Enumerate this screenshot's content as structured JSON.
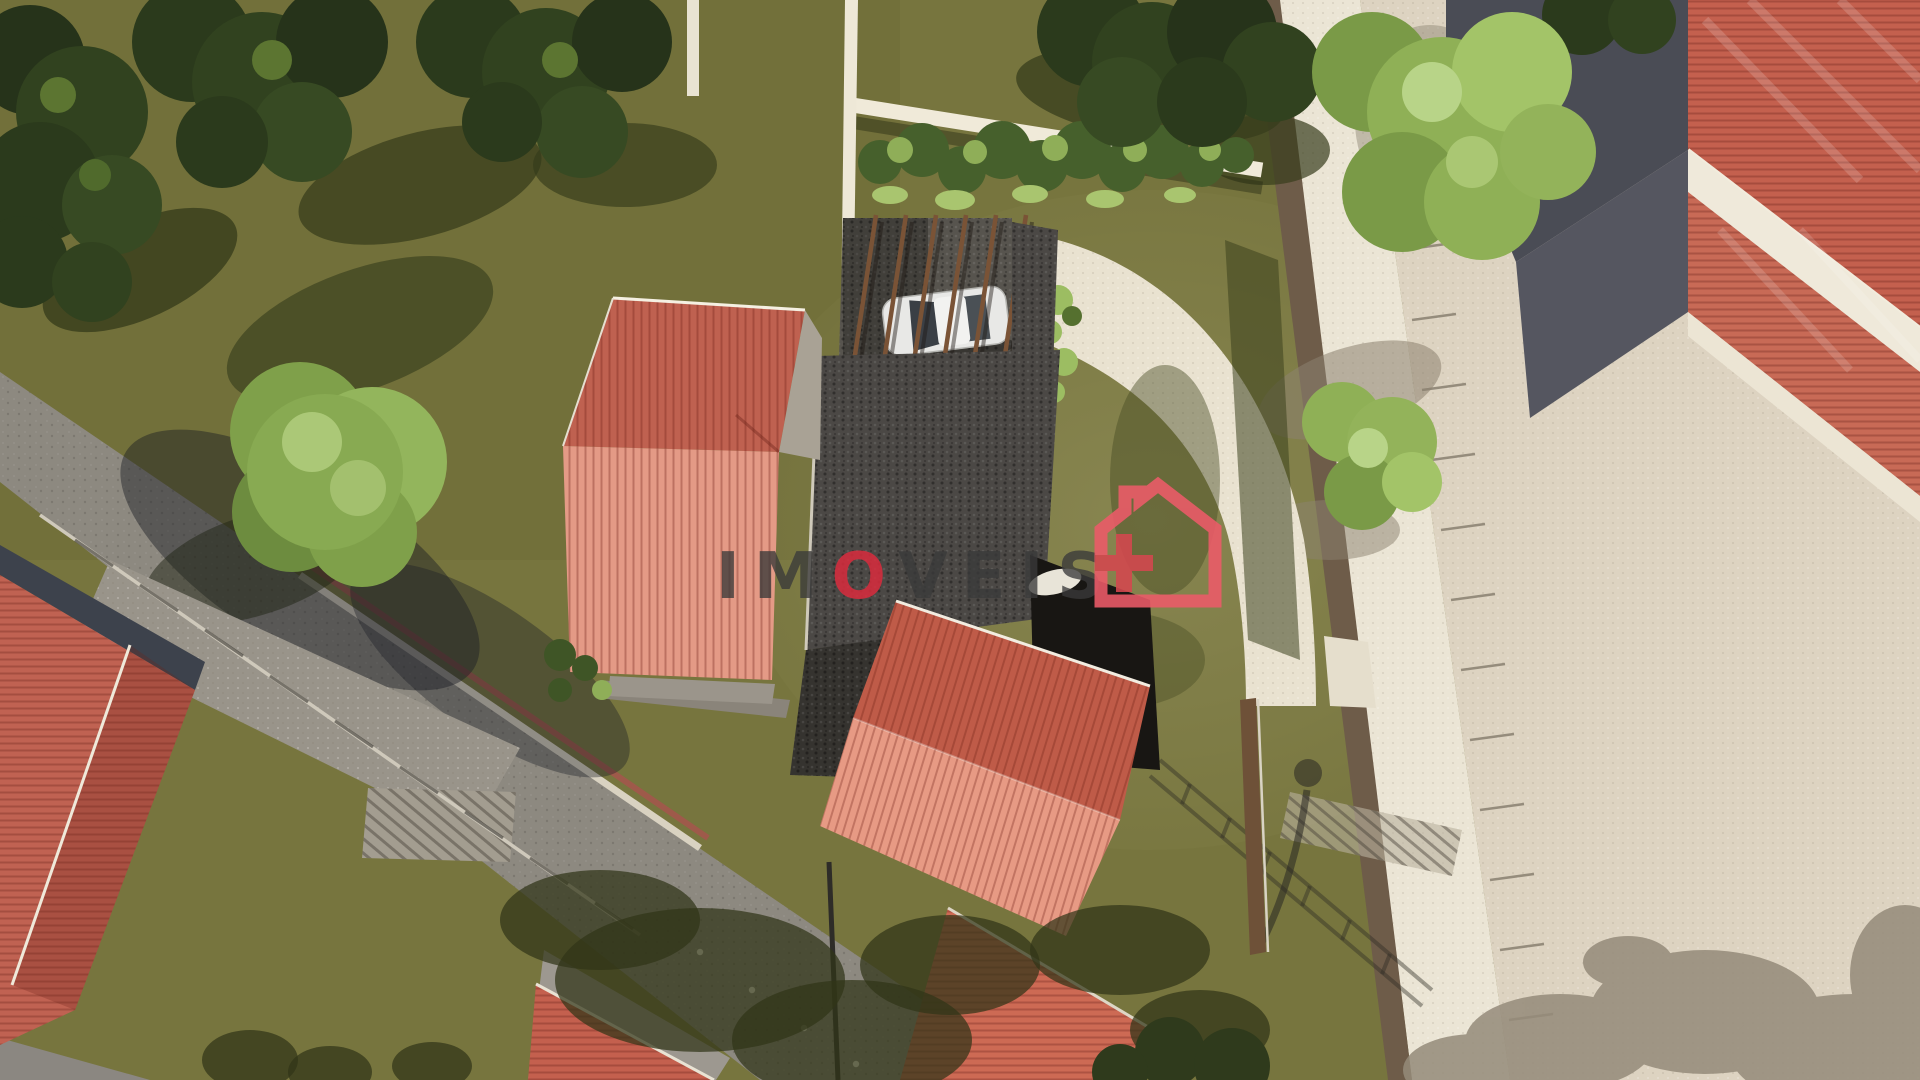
{
  "scene": {
    "type": "aerial-3d-architectural-render",
    "description": "Top-down aerial 3D rendering of a residential lot: central house with dark charcoal roof, pergola carport with white car, curved light driveway, neighbouring red clay-tile roofs, olive lawns, trees, gray access road with fence, and a beige street with parking marks on the right.",
    "objects": [
      "main-house-dark-roof",
      "carport-pergola",
      "white-car",
      "curved-driveway",
      "left-red-roof-house",
      "lower-red-roof-house",
      "bottom-left-red-roof-house",
      "top-right-building",
      "street-parking",
      "sidewalk",
      "boundary-wall",
      "street-lamp",
      "lawns",
      "trees",
      "fence",
      "garden-hedge"
    ]
  },
  "watermark": {
    "text": "IMOVEIS",
    "part1": "IM",
    "part2": "O",
    "part3": "VEIS",
    "text_color": "#3a3a3a",
    "o_color": "#d92b3d",
    "logo": "house-plus-icon",
    "logo_outline_color": "#ed5b69",
    "logo_plus_color": "#d4474f"
  },
  "palette": {
    "grass": "#77753e",
    "grass_shadow": "#3e4424",
    "road": "#8d8980",
    "pavement": "#ddd3c1",
    "sidewalk": "#ebe5d5",
    "red_roof": "#c4604e",
    "red_roof_light": "#e79a84",
    "dark_roof": "#4b4845",
    "wall_white": "#efe9da",
    "wall_brown": "#6e5c49",
    "tree_dark": "#2b3a1c",
    "tree_light": "#8fb056",
    "car": "#e8e8e6"
  }
}
